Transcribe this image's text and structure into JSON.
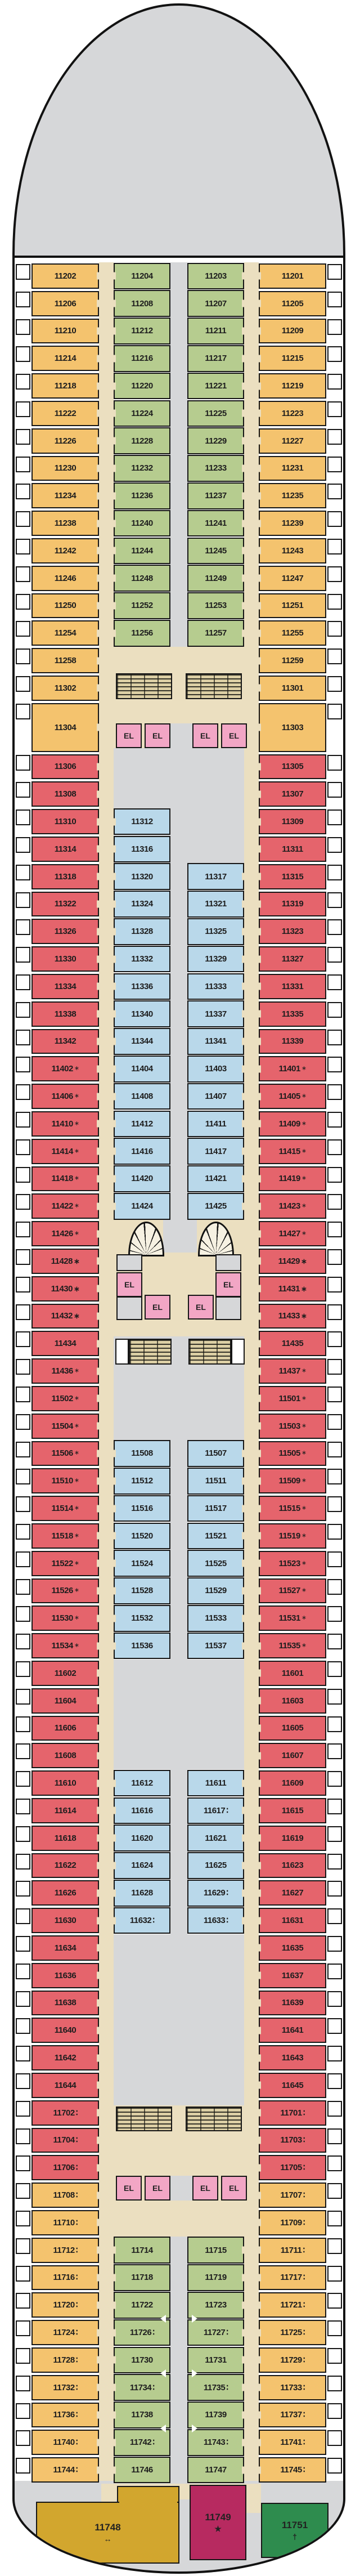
{
  "legend": {
    "elevator_label": "EL",
    "symbols": {
      "ast": "∗",
      "ast2": "∗",
      "berth": "∶",
      "bidir": "↔",
      "star": "★",
      "cross": "†"
    }
  },
  "colors": {
    "balcony_orange": "#F4C36E",
    "balcony_green": "#B6CC8F",
    "interior_blue": "#B9D8EA",
    "premium_red": "#E5646C",
    "elevator_pink": "#F2A6C5",
    "corridor_tan": "#EBDFC0",
    "deck_gray": "#D6D7D9",
    "stairs_tan": "#DCCFA4",
    "suite_gold": "#D2A62E",
    "suite_magenta": "#B72A60",
    "suite_green": "#2E8C4E",
    "outline": "#161616"
  },
  "deck": {
    "outer_left": [
      [
        "11202",
        "o"
      ],
      [
        "11206",
        "o"
      ],
      [
        "11210",
        "o"
      ],
      [
        "11214",
        "o"
      ],
      [
        "11218",
        "o"
      ],
      [
        "11222",
        "o"
      ],
      [
        "11226",
        "o"
      ],
      [
        "11230",
        "o"
      ],
      [
        "11234",
        "o"
      ],
      [
        "11238",
        "o"
      ],
      [
        "11242",
        "o"
      ],
      [
        "11246",
        "o"
      ],
      [
        "11250",
        "o"
      ],
      [
        "11254",
        "o"
      ],
      [
        "11258",
        "o"
      ],
      [
        "11302",
        "o"
      ],
      [
        "11304",
        "o"
      ],
      [
        "11306",
        "r"
      ],
      [
        "11308",
        "r"
      ],
      [
        "11310",
        "r"
      ],
      [
        "11314",
        "r"
      ],
      [
        "11318",
        "r"
      ],
      [
        "11322",
        "r"
      ],
      [
        "11326",
        "r"
      ],
      [
        "11330",
        "r"
      ],
      [
        "11334",
        "r"
      ],
      [
        "11338",
        "r"
      ],
      [
        "11342",
        "r"
      ],
      [
        "11402",
        "r",
        "ast"
      ],
      [
        "11406",
        "r",
        "ast"
      ],
      [
        "11410",
        "r",
        "ast"
      ],
      [
        "11414",
        "r",
        "ast"
      ],
      [
        "11418",
        "r",
        "ast"
      ],
      [
        "11422",
        "r",
        "ast"
      ],
      [
        "11426",
        "r",
        "ast"
      ],
      [
        "11428",
        "r",
        "ast2"
      ],
      [
        "11430",
        "r",
        "ast2"
      ],
      [
        "11432",
        "r",
        "ast2"
      ],
      [
        "11434",
        "r"
      ],
      [
        "11436",
        "r",
        "ast"
      ],
      [
        "11502",
        "r",
        "ast"
      ],
      [
        "11504",
        "r",
        "ast"
      ],
      [
        "11506",
        "r",
        "ast"
      ],
      [
        "11510",
        "r",
        "ast"
      ],
      [
        "11514",
        "r",
        "ast"
      ],
      [
        "11518",
        "r",
        "ast"
      ],
      [
        "11522",
        "r",
        "ast"
      ],
      [
        "11526",
        "r",
        "ast"
      ],
      [
        "11530",
        "r",
        "ast"
      ],
      [
        "11534",
        "r",
        "ast"
      ],
      [
        "11602",
        "r"
      ],
      [
        "11604",
        "r"
      ],
      [
        "11606",
        "r"
      ],
      [
        "11608",
        "r"
      ],
      [
        "11610",
        "r"
      ],
      [
        "11614",
        "r"
      ],
      [
        "11618",
        "r"
      ],
      [
        "11622",
        "r"
      ],
      [
        "11626",
        "r"
      ],
      [
        "11630",
        "r"
      ],
      [
        "11634",
        "r"
      ],
      [
        "11636",
        "r"
      ],
      [
        "11638",
        "r"
      ],
      [
        "11640",
        "r"
      ],
      [
        "11642",
        "r"
      ],
      [
        "11644",
        "r"
      ],
      [
        "11702",
        "r",
        "berth"
      ],
      [
        "11704",
        "r",
        "berth"
      ],
      [
        "11706",
        "r",
        "berth"
      ],
      [
        "11708",
        "o",
        "berth"
      ],
      [
        "11710",
        "o",
        "berth"
      ],
      [
        "11712",
        "o",
        "berth"
      ],
      [
        "11716",
        "o",
        "berth"
      ],
      [
        "11720",
        "o",
        "berth"
      ],
      [
        "11724",
        "o",
        "berth"
      ],
      [
        "11728",
        "o",
        "berth"
      ],
      [
        "11732",
        "o",
        "berth"
      ],
      [
        "11736",
        "o",
        "berth"
      ],
      [
        "11740",
        "o",
        "berth"
      ],
      [
        "11744",
        "o",
        "berth"
      ]
    ],
    "outer_right": [
      [
        "11201",
        "o"
      ],
      [
        "11205",
        "o"
      ],
      [
        "11209",
        "o"
      ],
      [
        "11215",
        "o"
      ],
      [
        "11219",
        "o"
      ],
      [
        "11223",
        "o"
      ],
      [
        "11227",
        "o"
      ],
      [
        "11231",
        "o"
      ],
      [
        "11235",
        "o"
      ],
      [
        "11239",
        "o"
      ],
      [
        "11243",
        "o"
      ],
      [
        "11247",
        "o"
      ],
      [
        "11251",
        "o"
      ],
      [
        "11255",
        "o"
      ],
      [
        "11259",
        "o"
      ],
      [
        "11301",
        "o"
      ],
      [
        "11303",
        "o"
      ],
      [
        "11305",
        "r"
      ],
      [
        "11307",
        "r"
      ],
      [
        "11309",
        "r"
      ],
      [
        "11311",
        "r"
      ],
      [
        "11315",
        "r"
      ],
      [
        "11319",
        "r"
      ],
      [
        "11323",
        "r"
      ],
      [
        "11327",
        "r"
      ],
      [
        "11331",
        "r"
      ],
      [
        "11335",
        "r"
      ],
      [
        "11339",
        "r"
      ],
      [
        "11401",
        "r",
        "ast"
      ],
      [
        "11405",
        "r",
        "ast"
      ],
      [
        "11409",
        "r",
        "ast"
      ],
      [
        "11415",
        "r",
        "ast"
      ],
      [
        "11419",
        "r",
        "ast"
      ],
      [
        "11423",
        "r",
        "ast"
      ],
      [
        "11427",
        "r",
        "ast"
      ],
      [
        "11429",
        "r",
        "ast2"
      ],
      [
        "11431",
        "r",
        "ast2"
      ],
      [
        "11433",
        "r",
        "ast2"
      ],
      [
        "11435",
        "r"
      ],
      [
        "11437",
        "r",
        "ast"
      ],
      [
        "11501",
        "r",
        "ast"
      ],
      [
        "11503",
        "r",
        "ast"
      ],
      [
        "11505",
        "r",
        "ast"
      ],
      [
        "11509",
        "r",
        "ast"
      ],
      [
        "11515",
        "r",
        "ast"
      ],
      [
        "11519",
        "r",
        "ast"
      ],
      [
        "11523",
        "r",
        "ast"
      ],
      [
        "11527",
        "r",
        "ast"
      ],
      [
        "11531",
        "r",
        "ast"
      ],
      [
        "11535",
        "r",
        "ast"
      ],
      [
        "11601",
        "r"
      ],
      [
        "11603",
        "r"
      ],
      [
        "11605",
        "r"
      ],
      [
        "11607",
        "r"
      ],
      [
        "11609",
        "r"
      ],
      [
        "11615",
        "r"
      ],
      [
        "11619",
        "r"
      ],
      [
        "11623",
        "r"
      ],
      [
        "11627",
        "r"
      ],
      [
        "11631",
        "r"
      ],
      [
        "11635",
        "r"
      ],
      [
        "11637",
        "r"
      ],
      [
        "11639",
        "r"
      ],
      [
        "11641",
        "r"
      ],
      [
        "11643",
        "r"
      ],
      [
        "11645",
        "r"
      ],
      [
        "11701",
        "r",
        "berth"
      ],
      [
        "11703",
        "r",
        "berth"
      ],
      [
        "11705",
        "r",
        "berth"
      ],
      [
        "11707",
        "o",
        "berth"
      ],
      [
        "11709",
        "o",
        "berth"
      ],
      [
        "11711",
        "o",
        "berth"
      ],
      [
        "11717",
        "o",
        "berth"
      ],
      [
        "11721",
        "o",
        "berth"
      ],
      [
        "11725",
        "o",
        "berth"
      ],
      [
        "11729",
        "o",
        "berth"
      ],
      [
        "11733",
        "o",
        "berth"
      ],
      [
        "11737",
        "o",
        "berth"
      ],
      [
        "11741",
        "o",
        "berth"
      ],
      [
        "11745",
        "o",
        "berth"
      ]
    ],
    "inner_left": [
      [
        0,
        "11204",
        "g"
      ],
      [
        1,
        "11208",
        "g"
      ],
      [
        2,
        "11212",
        "g"
      ],
      [
        3,
        "11216",
        "g"
      ],
      [
        4,
        "11220",
        "g"
      ],
      [
        5,
        "11224",
        "g"
      ],
      [
        6,
        "11228",
        "g"
      ],
      [
        7,
        "11232",
        "g"
      ],
      [
        8,
        "11236",
        "g"
      ],
      [
        9,
        "11240",
        "g"
      ],
      [
        10,
        "11244",
        "g"
      ],
      [
        11,
        "11248",
        "g"
      ],
      [
        12,
        "11252",
        "g"
      ],
      [
        13,
        "11256",
        "g"
      ],
      [
        19,
        "11312",
        "b"
      ],
      [
        20,
        "11316",
        "b"
      ],
      [
        21,
        "11320",
        "b"
      ],
      [
        22,
        "11324",
        "b"
      ],
      [
        23,
        "11328",
        "b"
      ],
      [
        24,
        "11332",
        "b"
      ],
      [
        25,
        "11336",
        "b"
      ],
      [
        26,
        "11340",
        "b"
      ],
      [
        27,
        "11344",
        "b"
      ],
      [
        28,
        "11404",
        "b"
      ],
      [
        29,
        "11408",
        "b"
      ],
      [
        30,
        "11412",
        "b"
      ],
      [
        31,
        "11416",
        "b"
      ],
      [
        32,
        "11420",
        "b"
      ],
      [
        33,
        "11424",
        "b"
      ],
      [
        42,
        "11508",
        "b"
      ],
      [
        43,
        "11512",
        "b"
      ],
      [
        44,
        "11516",
        "b"
      ],
      [
        45,
        "11520",
        "b"
      ],
      [
        46,
        "11524",
        "b"
      ],
      [
        47,
        "11528",
        "b"
      ],
      [
        48,
        "11532",
        "b"
      ],
      [
        49,
        "11536",
        "b"
      ],
      [
        54,
        "11612",
        "b"
      ],
      [
        55,
        "11616",
        "b"
      ],
      [
        56,
        "11620",
        "b"
      ],
      [
        57,
        "11624",
        "b"
      ],
      [
        58,
        "11628",
        "b"
      ],
      [
        59,
        "11632",
        "b",
        "berth"
      ],
      [
        71,
        "11714",
        "g"
      ],
      [
        72,
        "11718",
        "g"
      ],
      [
        73,
        "11722",
        "g",
        "",
        "l"
      ],
      [
        74,
        "11726",
        "g",
        "berth"
      ],
      [
        75,
        "11730",
        "g",
        "",
        "l"
      ],
      [
        76,
        "11734",
        "g",
        "berth"
      ],
      [
        77,
        "11738",
        "g",
        "",
        "l"
      ],
      [
        78,
        "11742",
        "g",
        "berth"
      ],
      [
        79,
        "11746",
        "g"
      ]
    ],
    "inner_right": [
      [
        0,
        "11203",
        "g"
      ],
      [
        1,
        "11207",
        "g"
      ],
      [
        2,
        "11211",
        "g"
      ],
      [
        3,
        "11217",
        "g"
      ],
      [
        4,
        "11221",
        "g"
      ],
      [
        5,
        "11225",
        "g"
      ],
      [
        6,
        "11229",
        "g"
      ],
      [
        7,
        "11233",
        "g"
      ],
      [
        8,
        "11237",
        "g"
      ],
      [
        9,
        "11241",
        "g"
      ],
      [
        10,
        "11245",
        "g"
      ],
      [
        11,
        "11249",
        "g"
      ],
      [
        12,
        "11253",
        "g"
      ],
      [
        13,
        "11257",
        "g"
      ],
      [
        21,
        "11317",
        "b"
      ],
      [
        22,
        "11321",
        "b"
      ],
      [
        23,
        "11325",
        "b"
      ],
      [
        24,
        "11329",
        "b"
      ],
      [
        25,
        "11333",
        "b"
      ],
      [
        26,
        "11337",
        "b"
      ],
      [
        27,
        "11341",
        "b"
      ],
      [
        28,
        "11403",
        "b"
      ],
      [
        29,
        "11407",
        "b"
      ],
      [
        30,
        "11411",
        "b"
      ],
      [
        31,
        "11417",
        "b"
      ],
      [
        32,
        "11421",
        "b"
      ],
      [
        33,
        "11425",
        "b"
      ],
      [
        42,
        "11507",
        "b"
      ],
      [
        43,
        "11511",
        "b"
      ],
      [
        44,
        "11517",
        "b"
      ],
      [
        45,
        "11521",
        "b"
      ],
      [
        46,
        "11525",
        "b"
      ],
      [
        47,
        "11529",
        "b"
      ],
      [
        48,
        "11533",
        "b"
      ],
      [
        49,
        "11537",
        "b"
      ],
      [
        54,
        "11611",
        "b"
      ],
      [
        55,
        "11617",
        "b",
        "berth"
      ],
      [
        56,
        "11621",
        "b"
      ],
      [
        57,
        "11625",
        "b"
      ],
      [
        58,
        "11629",
        "b",
        "berth"
      ],
      [
        59,
        "11633",
        "b",
        "berth"
      ],
      [
        71,
        "11715",
        "g"
      ],
      [
        72,
        "11719",
        "g"
      ],
      [
        73,
        "11723",
        "g",
        "",
        "r"
      ],
      [
        74,
        "11727",
        "g",
        "berth"
      ],
      [
        75,
        "11731",
        "g",
        "",
        "r"
      ],
      [
        76,
        "11735",
        "g",
        "berth"
      ],
      [
        77,
        "11739",
        "g",
        "",
        "r"
      ],
      [
        78,
        "11743",
        "g",
        "berth"
      ],
      [
        79,
        "11747",
        "g"
      ]
    ],
    "suites": [
      {
        "n": "11748",
        "c": "suite_gold",
        "s": "bidir"
      },
      {
        "n": "11749",
        "c": "suite_magenta",
        "s": "star"
      },
      {
        "n": "11751",
        "c": "suite_green",
        "s": "cross"
      }
    ],
    "elevator_banks": [
      {
        "id": "forward",
        "cars": 4
      },
      {
        "id": "midship",
        "cars": 4
      },
      {
        "id": "aft",
        "cars": 4
      }
    ]
  }
}
